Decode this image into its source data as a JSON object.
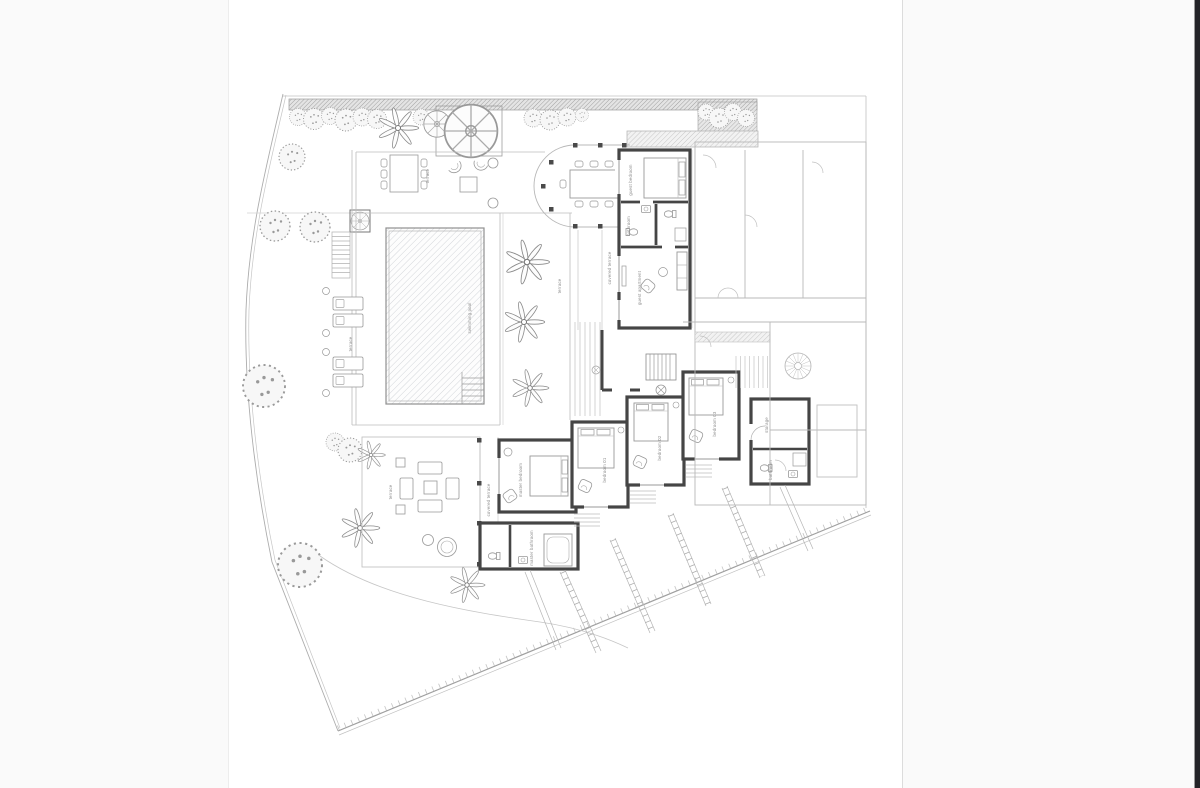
{
  "window": {
    "background_color": "#fafafa",
    "paper_color": "#ffffff",
    "edge_strip_color": "#232327"
  },
  "plan": {
    "colors": {
      "wall": "#454545",
      "light_line": "#b4b4b4",
      "furniture_line": "#999999",
      "hatch": "#9a9a9a",
      "label_text": "#8f8f8f"
    },
    "labels": {
      "swimming_pool": "swimming pool",
      "terrace_upper": "terrace",
      "terrace_palm": "terrace",
      "terrace_lounge": "terrace",
      "pool_deck": "terrace",
      "guest_bedroom": "guest bedroom",
      "guest_bathroom": "bathroom",
      "guest_apartment": "guest apartment",
      "covered_terrace_upper": "covered terrace",
      "covered_terrace_lower": "covered terrace",
      "master_bedroom": "master bedroom",
      "master_bathroom": "master bathroom",
      "bedroom_01": "bedroom 01",
      "bedroom_02": "bedroom 02",
      "bedroom_03": "bedroom 03",
      "storage": "storage",
      "bathroom": "bathroom"
    }
  }
}
